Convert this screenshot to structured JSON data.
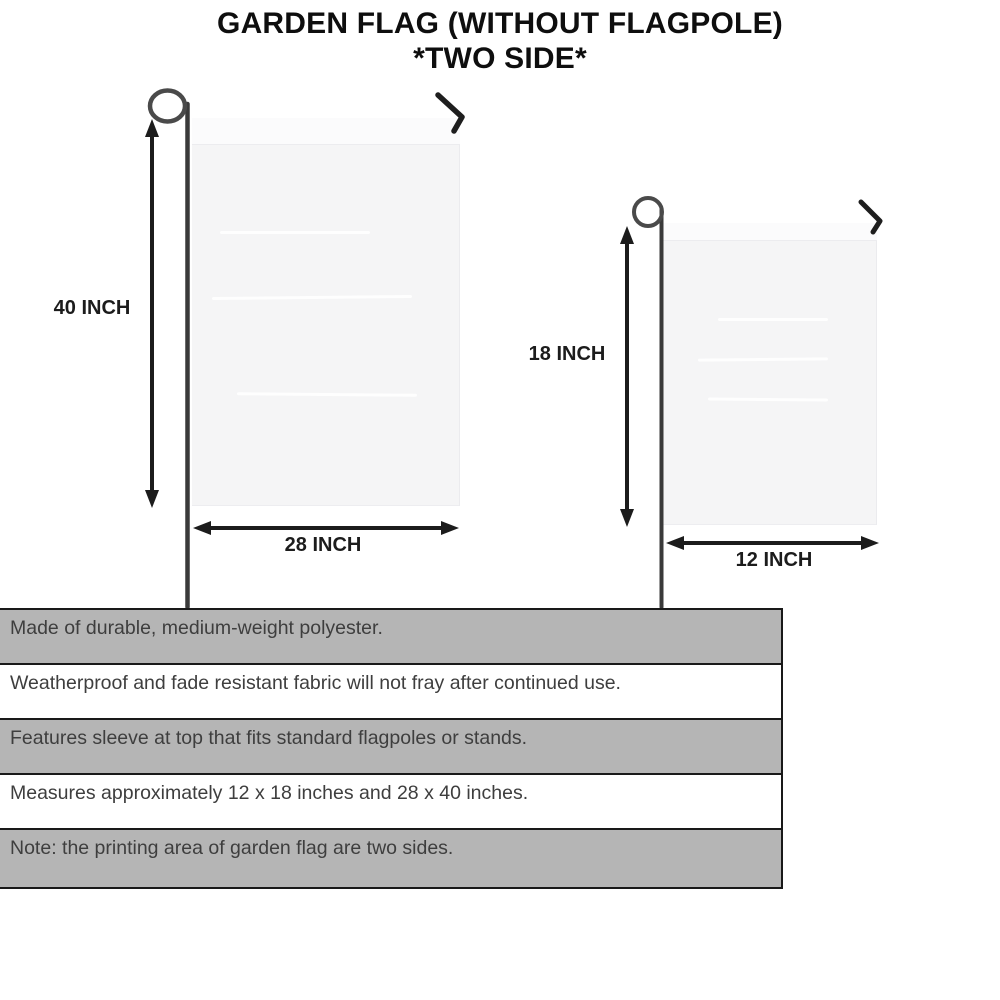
{
  "title": {
    "line1": "GARDEN FLAG (WITHOUT FLAGPOLE)",
    "line2": "*TWO SIDE*"
  },
  "diagram": {
    "large_flag": {
      "height_label": "40 INCH",
      "width_label": "28 INCH"
    },
    "small_flag": {
      "height_label": "18 INCH",
      "width_label": "12 INCH"
    }
  },
  "features": [
    "Made of durable, medium-weight polyester.",
    "Weatherproof and fade resistant fabric will not fray after continued use.",
    "Features sleeve at top that fits standard flagpoles or stands.",
    "Measures approximately 12 x 18 inches and 28 x 40 inches.",
    "Note: the printing area of garden flag are two sides."
  ],
  "colors": {
    "row_gray": "#b5b5b5",
    "row_white": "#ffffff",
    "flag_fill": "#f5f5f6",
    "line_dark": "#1c1c1c",
    "text_dark": "#3e3e3e"
  }
}
